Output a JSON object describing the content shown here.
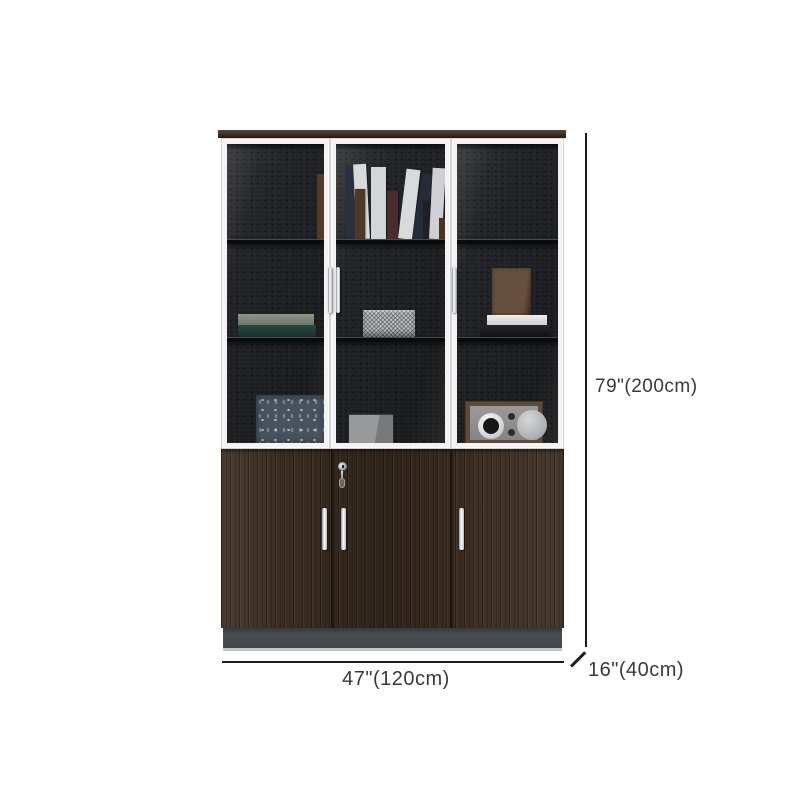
{
  "canvas": {
    "background": "#ffffff"
  },
  "annotations": {
    "height_label": "79\"(200cm)",
    "width_label": "47\"(120cm)",
    "depth_label": "16\"(40cm)",
    "line_color": "#1c1c1c",
    "text_color": "#3a3a3a"
  },
  "cabinet": {
    "colors": {
      "top_strip_wood": "#3f2e22",
      "door_frame_white": "#f3f3f4",
      "interior_dark": "#222427",
      "lower_wood": "#3b2d21",
      "plinth_gray": "#45484b",
      "handle_chrome": "#fbfdfe",
      "shelf_edge": "#474b50",
      "basket_weave": "#c0c4c6",
      "artboard_blue": "#49515d",
      "book_teal": "#1e3c34"
    }
  }
}
